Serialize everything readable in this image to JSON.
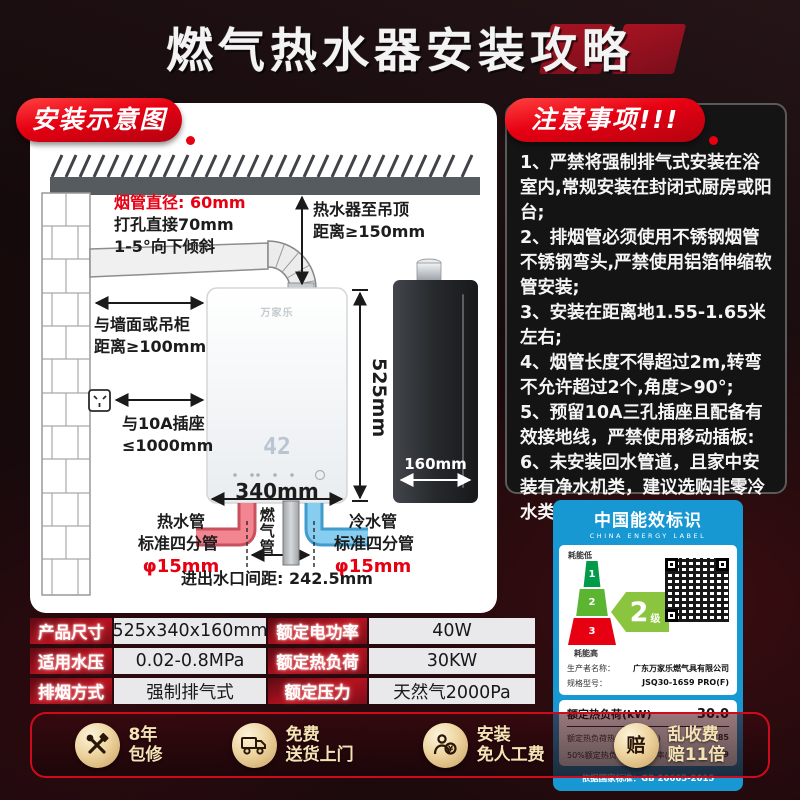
{
  "title": "燃气热水器安装攻略",
  "install_diagram": {
    "badge": "安装示意图",
    "flue_diameter": "烟管直径: 60mm",
    "hole_note": "打孔直接70mm",
    "tilt_note": "1-5°向下倾斜",
    "ceiling_distance_1": "热水器至吊顶",
    "ceiling_distance_2": "距离≥150mm",
    "wall_distance_1": "与墙面或吊柜",
    "wall_distance_2": "距离≥100mm",
    "socket_distance_1": "与10A插座",
    "socket_distance_2": "≤1000mm",
    "height_label": "525mm",
    "width_label": "340mm",
    "depth_label": "160mm",
    "heater_logo": "万家乐",
    "display_value": "42",
    "hot_pipe_1": "热水管",
    "hot_pipe_2": "标准四分管",
    "hot_pipe_3": "φ15mm",
    "gas_pipe": "燃气管",
    "cold_pipe_1": "冷水管",
    "cold_pipe_2": "标准四分管",
    "cold_pipe_3": "φ15mm",
    "port_spacing": "进出水口间距: 242.5mm"
  },
  "notices": {
    "badge": "注意事项!!!",
    "items": [
      "1、严禁将强制排气式安装在浴室内,常规安装在封闭式厨房或阳台;",
      "2、排烟管必须使用不锈钢烟管不锈钢弯头,严禁使用铝箔伸缩软管安装;",
      "3、安装在距离地1.55-1.65米左右;",
      "4、烟管长度不得超过2m,转弯不允许超过2个,角度>90°;",
      "5、预留10A三孔插座且配备有效接地线，严禁使用移动插板:",
      "6、未安装回水管道，且家中安装有净水机类，建议选购非零冷水类燃气热水器。"
    ]
  },
  "energy_label": {
    "title_cn": "中国能效标识",
    "title_en": "CHINA ENERGY LABEL",
    "low_label": "耗能低",
    "high_label": "耗能高",
    "tiers": [
      "1",
      "2",
      "3"
    ],
    "grade_number": "2",
    "grade_suffix": "级",
    "producer_label": "生产者名称：",
    "producer_value": "广东万家乐燃气具有限公司",
    "model_label": "规格型号：",
    "model_value": "JSQ30-16S9 PRO(F)",
    "heat_load_label": "额定热负荷(kW)",
    "heat_load_value": "30.0",
    "eff1_label": "额定热负荷热水热效率(%)",
    "eff1_value": "85",
    "eff2_label": "50%额定热负荷热水热效率(%)",
    "eff2_value": "89",
    "standard": "依据国家标准：GB 20665-2015"
  },
  "spec_table": {
    "rows": [
      [
        "产品尺寸",
        "525x340x160mm",
        "额定电功率",
        "40W"
      ],
      [
        "适用水压",
        "0.02-0.8MPa",
        "额定热负荷",
        "30KW"
      ],
      [
        "排烟方式",
        "强制排气式",
        "额定压力",
        "天然气2000Pa"
      ]
    ]
  },
  "services": {
    "items": [
      {
        "icon": "tools-icon",
        "line1": "8年",
        "line2": "包修"
      },
      {
        "icon": "truck-icon",
        "line1": "免费",
        "line2": "送货上门"
      },
      {
        "icon": "installer-icon",
        "line1": "安装",
        "line2": "免人工费"
      },
      {
        "icon": "compensation-icon",
        "line1": "乱收费",
        "line2": "赔11倍"
      }
    ]
  },
  "colors": {
    "accent_red": "#e60012",
    "energy_blue": "#1798d3",
    "hot_pipe": "#f2858f",
    "cold_pipe": "#86cdef",
    "gold_text": "#f6e3b5"
  }
}
